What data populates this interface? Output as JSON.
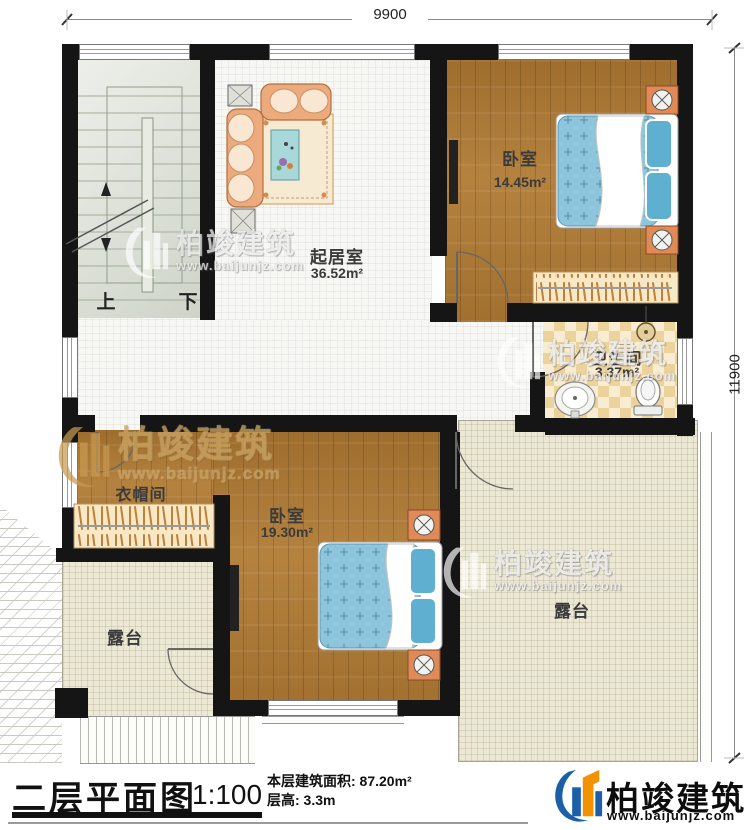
{
  "dimensions": {
    "top": "9900",
    "right": "11900"
  },
  "stairs": {
    "up_label": "上",
    "down_label": "下"
  },
  "rooms": {
    "living": {
      "name": "起居室",
      "area": "36.52m²"
    },
    "bedroom1": {
      "name": "卧室",
      "area": "14.45m²"
    },
    "bathroom": {
      "name": "卫生间",
      "area": "3.37m²"
    },
    "cloakroom": {
      "name": "衣帽间"
    },
    "bedroom2": {
      "name": "卧室",
      "area": "19.30m²"
    },
    "terrace_left": {
      "name": "露台"
    },
    "terrace_right": {
      "name": "露台"
    }
  },
  "watermark": {
    "name": "柏竣建筑",
    "url": "www.baijunjz.com"
  },
  "footer": {
    "title": "二层平面图",
    "scale": "1:100",
    "area_line": "本层建筑面积: 87.20m²",
    "height_line": "层高: 3.3m",
    "brand_name": "柏竣建筑",
    "brand_url": "www.baijunjz.com"
  },
  "colors": {
    "wall": "#151515",
    "wood": "#b07a33",
    "tile": "#f7f7f4",
    "bath_tile": "#ecd29b",
    "terrace": "#ece8d6",
    "stair_floor": "#dbe1d5",
    "bed": "#8cc5dc",
    "brand_blue": "#1a5fa8",
    "brand_orange": "#f29200"
  }
}
